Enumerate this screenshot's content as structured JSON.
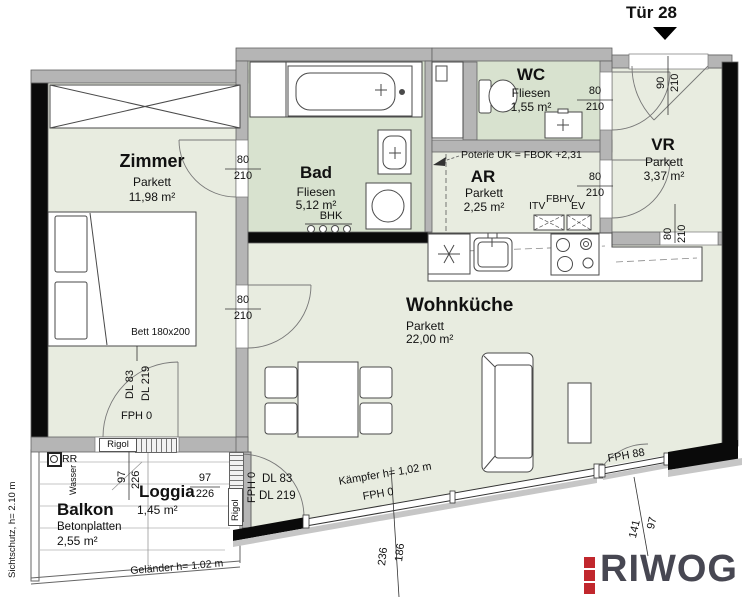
{
  "header": {
    "door_label": "Tür 28"
  },
  "rooms": {
    "zimmer": {
      "name": "Zimmer",
      "floor": "Parkett",
      "area": "11,98 m²"
    },
    "bad": {
      "name": "Bad",
      "floor": "Fliesen",
      "area": "5,12 m²"
    },
    "wc": {
      "name": "WC",
      "floor": "Fliesen",
      "area": "1,55 m²"
    },
    "vr": {
      "name": "VR",
      "floor": "Parkett",
      "area": "3,37 m²"
    },
    "ar": {
      "name": "AR",
      "floor": "Parkett",
      "area": "2,25 m²"
    },
    "wohnkueche": {
      "name": "Wohnküche",
      "floor": "Parkett",
      "area": "22,00 m²"
    },
    "loggia": {
      "name": "Loggia",
      "area": "1,45 m²"
    },
    "balkon": {
      "name": "Balkon",
      "floor": "Betonplatten",
      "area": "2,55 m²"
    }
  },
  "dims": {
    "d80": "80",
    "d90": "90",
    "d97": "97",
    "d141": "141",
    "d186": "186",
    "d210": "210",
    "d226": "226",
    "d236": "236"
  },
  "annotations": {
    "poterie": "Poterie UK = FBOK +2,31",
    "bett": "Bett 180x200",
    "bhk": "BHK",
    "itv": "ITV",
    "fbhv": "FBHV",
    "ev": "EV",
    "kaempfer": "Kämpfer h= 1,02 m",
    "fph0": "FPH 0",
    "fph88": "FPH 88",
    "dl83": "DL 83",
    "dl219": "DL 219",
    "rigol": "Rigol",
    "rr": "RR",
    "wasser": "Wasser",
    "gelaender": "Geländer h= 1.02 m",
    "sichtschutz": "Sichtschutz, h= 2.10 m"
  },
  "logo": {
    "text": "RIWOG"
  },
  "colors": {
    "floor_parquet": "#e8ece0",
    "floor_tile": "#d8e2cf",
    "wall_grey": "#b5b5b5",
    "wall_black": "#0a0a0a",
    "logo_text": "#474752",
    "logo_accent": "#c1272d"
  }
}
